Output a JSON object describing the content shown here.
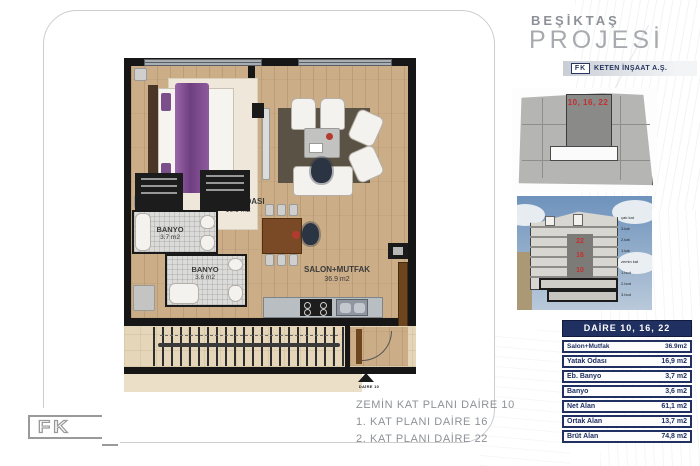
{
  "header": {
    "eyebrow": "BEŞİKTAŞ",
    "title": "PROJESİ",
    "brand_fk": "FK",
    "brand_name": "KETEN İNŞAAT A.Ş."
  },
  "keyplan": {
    "unit_label": "10, 16, 22"
  },
  "section": {
    "unit_floors": [
      "22",
      "16",
      "10"
    ],
    "floor_labels": [
      "çatı kat",
      "3.kat",
      "2.kat",
      "1.kat",
      "zemin kat",
      "1.bod",
      "2.bod",
      "3.bod"
    ]
  },
  "plan": {
    "bedroom": {
      "name": "YATAK ODASI",
      "area": "16.9 m2"
    },
    "bathroom1": {
      "name": "BANYO",
      "area": "3.7 m2"
    },
    "bathroom2": {
      "name": "BANYO",
      "area": "3.6 m2"
    },
    "salon": {
      "name": "SALON+MUTFAK",
      "area": "36.9 m2"
    },
    "entry_marker": "DAİRE 10"
  },
  "captions": [
    "ZEMİN KAT PLANI DAİRE 10",
    "1. KAT PLANI DAİRE 16",
    "2. KAT PLANI DAİRE 22"
  ],
  "table": {
    "header": "DAİRE 10, 16, 22",
    "rows": [
      {
        "label": "Salon+Mutfak",
        "value": "36.9m2"
      },
      {
        "label": "Yatak Odası",
        "value": "16,9 m2"
      },
      {
        "label": "Eb. Banyo",
        "value": "3,7 m2"
      },
      {
        "label": "Banyo",
        "value": "3,6 m2"
      },
      {
        "label": "Net Alan",
        "value": "61,1 m2"
      },
      {
        "label": "Ortak Alan",
        "value": "13,7 m2"
      },
      {
        "label": "Brüt Alan",
        "value": "74,8 m2"
      }
    ]
  },
  "footer": {
    "logo": "FK"
  },
  "colors": {
    "navy": "#203061",
    "red": "#c03030",
    "wood": "#cbad87",
    "sky": "#6e92bc"
  }
}
